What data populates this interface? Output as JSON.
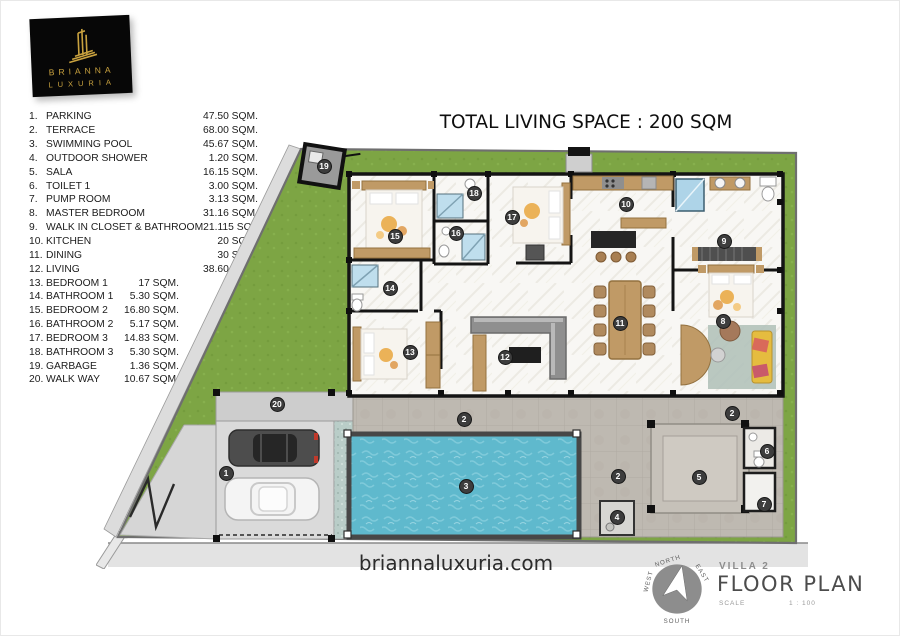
{
  "logo": {
    "line1": "BRIANNA",
    "line2": "LUXURIA"
  },
  "header": {
    "title": "TOTAL LIVING SPACE : 200 SQM"
  },
  "legend": {
    "items": [
      {
        "num": "1.",
        "label": "PARKING",
        "area": "47.50 SQM."
      },
      {
        "num": "2.",
        "label": "TERRACE",
        "area": "68.00 SQM."
      },
      {
        "num": "3.",
        "label": "SWIMMING POOL",
        "area": "45.67 SQM."
      },
      {
        "num": "4.",
        "label": "OUTDOOR SHOWER",
        "area": "1.20 SQM."
      },
      {
        "num": "5.",
        "label": "SALA",
        "area": "16.15 SQM."
      },
      {
        "num": "6.",
        "label": "TOILET 1",
        "area": "3.00 SQM."
      },
      {
        "num": "7.",
        "label": "PUMP ROOM",
        "area": "3.13 SQM."
      },
      {
        "num": "8.",
        "label": "MASTER BEDROOM",
        "area": "31.16 SQM."
      },
      {
        "num": "9.",
        "label": "WALK IN CLOSET & BATHROOM",
        "area": "21.115 SQM."
      },
      {
        "num": "10.",
        "label": "KITCHEN",
        "area": "20 SQM."
      },
      {
        "num": "11.",
        "label": "DINING",
        "area": "30 SQM."
      },
      {
        "num": "12.",
        "label": "LIVING",
        "area": "38.60 SQM."
      },
      {
        "num": "13.",
        "label": "BEDROOM 1",
        "area": "17 SQM."
      },
      {
        "num": "14.",
        "label": "BATHROOM 1",
        "area": "5.30 SQM."
      },
      {
        "num": "15.",
        "label": "BEDROOM 2",
        "area": "16.80 SQM."
      },
      {
        "num": "16.",
        "label": "BATHROOM 2",
        "area": "5.17 SQM."
      },
      {
        "num": "17.",
        "label": "BEDROOM 3",
        "area": "14.83 SQM."
      },
      {
        "num": "18.",
        "label": "BATHROOM 3",
        "area": "5.30 SQM."
      },
      {
        "num": "19.",
        "label": "GARBAGE",
        "area": "1.36 SQM."
      },
      {
        "num": "20.",
        "label": "WALK WAY",
        "area": "10.67 SQM."
      }
    ]
  },
  "plan": {
    "markers": [
      {
        "n": "1",
        "x": 130,
        "y": 334
      },
      {
        "n": "2",
        "x": 368,
        "y": 280
      },
      {
        "n": "2",
        "x": 636,
        "y": 274
      },
      {
        "n": "2",
        "x": 522,
        "y": 337
      },
      {
        "n": "3",
        "x": 370,
        "y": 347
      },
      {
        "n": "4",
        "x": 521,
        "y": 378
      },
      {
        "n": "5",
        "x": 603,
        "y": 338
      },
      {
        "n": "6",
        "x": 671,
        "y": 312
      },
      {
        "n": "7",
        "x": 668,
        "y": 365
      },
      {
        "n": "8",
        "x": 627,
        "y": 182
      },
      {
        "n": "9",
        "x": 628,
        "y": 102
      },
      {
        "n": "10",
        "x": 530,
        "y": 65
      },
      {
        "n": "11",
        "x": 524,
        "y": 184
      },
      {
        "n": "12",
        "x": 409,
        "y": 218
      },
      {
        "n": "13",
        "x": 314,
        "y": 213
      },
      {
        "n": "14",
        "x": 294,
        "y": 149
      },
      {
        "n": "15",
        "x": 299,
        "y": 97
      },
      {
        "n": "16",
        "x": 360,
        "y": 94
      },
      {
        "n": "17",
        "x": 416,
        "y": 78
      },
      {
        "n": "18",
        "x": 378,
        "y": 54
      },
      {
        "n": "19",
        "x": 228,
        "y": 27
      },
      {
        "n": "20",
        "x": 181,
        "y": 265
      }
    ]
  },
  "footer": {
    "website": "briannaluxuria.com"
  },
  "titleblock": {
    "villa": "VILLA 2",
    "name": "FLOOR PLAN",
    "scale_label": "SCALE",
    "scale_value": "1 : 100"
  },
  "compass": {
    "north": "NORTH",
    "east": "EAST",
    "south": "SOUTH",
    "west": "WEST"
  },
  "colors": {
    "gold": "#c9a23f",
    "lawn": "#7da544",
    "pool": "#5fb9cd",
    "terrace": "#beb9b1",
    "wood": "#c09a66",
    "marker": "#3d3d3d"
  }
}
